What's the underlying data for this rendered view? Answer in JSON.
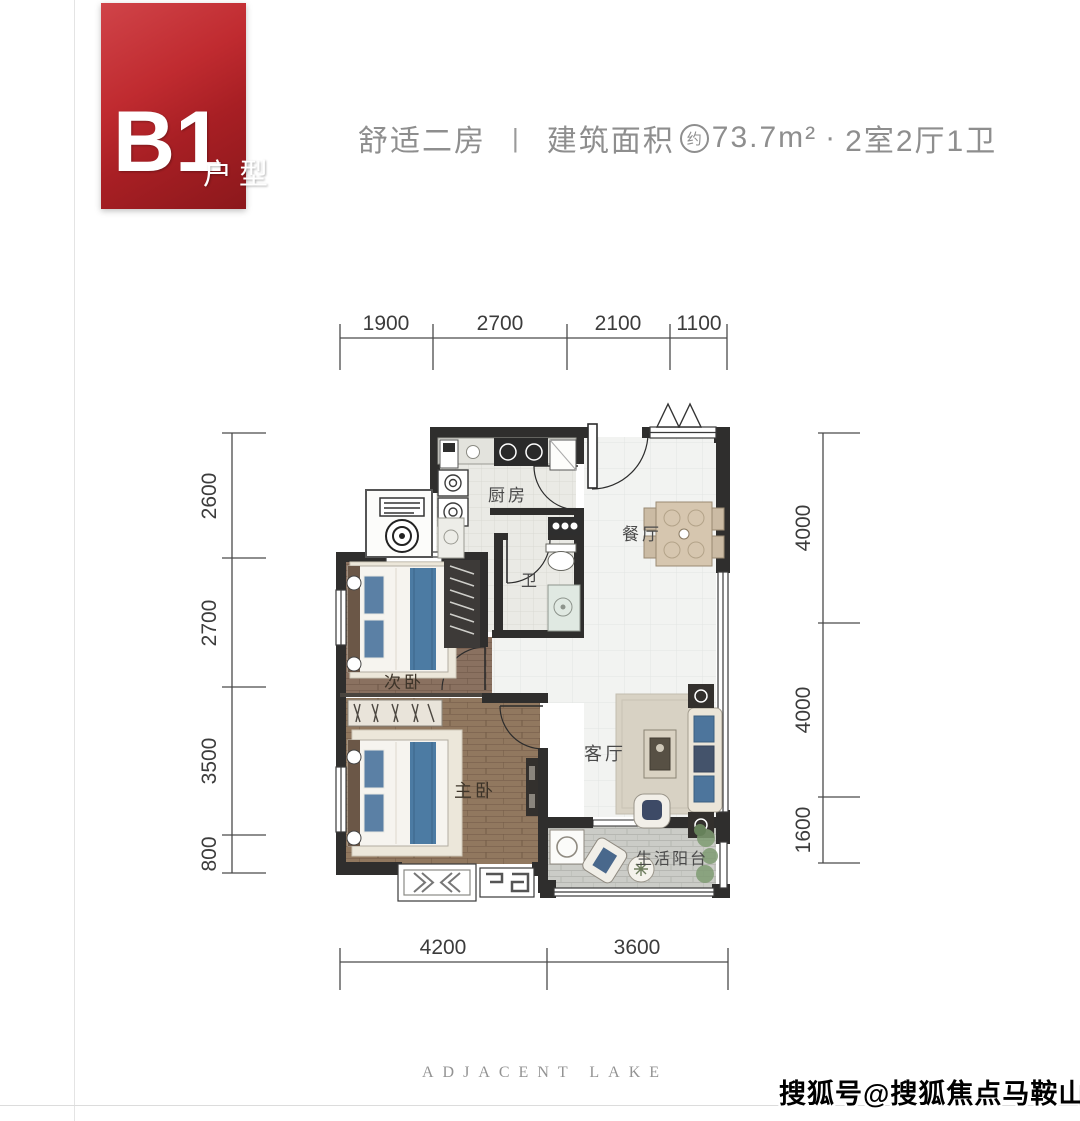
{
  "badge": {
    "code": "B1",
    "suffix": "户型"
  },
  "header": {
    "subtitle": "舒适二房",
    "separator": "|",
    "area_label": "建筑面积",
    "area_approx": "约",
    "area_value": "73.7m²",
    "dot": "·",
    "layout": "2室2厅1卫"
  },
  "plan": {
    "rooms": {
      "kitchen": "厨房",
      "dining": "餐厅",
      "bath": "卫",
      "bedroom2": "次卧",
      "master": "主卧",
      "living": "客厅",
      "balcony": "生活阳台"
    },
    "dims": {
      "top": [
        "1900",
        "2700",
        "2100",
        "1100"
      ],
      "left": [
        "2600",
        "2700",
        "3500",
        "800"
      ],
      "right": [
        "4000",
        "4000",
        "1600"
      ],
      "bottom": [
        "4200",
        "3600"
      ]
    }
  },
  "footer": {
    "brand": "ADJACENT LAKE"
  },
  "watermark": "搜狐号@搜狐焦点马鞍山站",
  "colors": {
    "accent_red": "#b02025",
    "wall": "#2f2e2d",
    "wood": "#8a7160",
    "dim_line": "#4a4a4a",
    "text_gray": "#8e8e8e",
    "bed_blue": "#4c7ba3"
  }
}
